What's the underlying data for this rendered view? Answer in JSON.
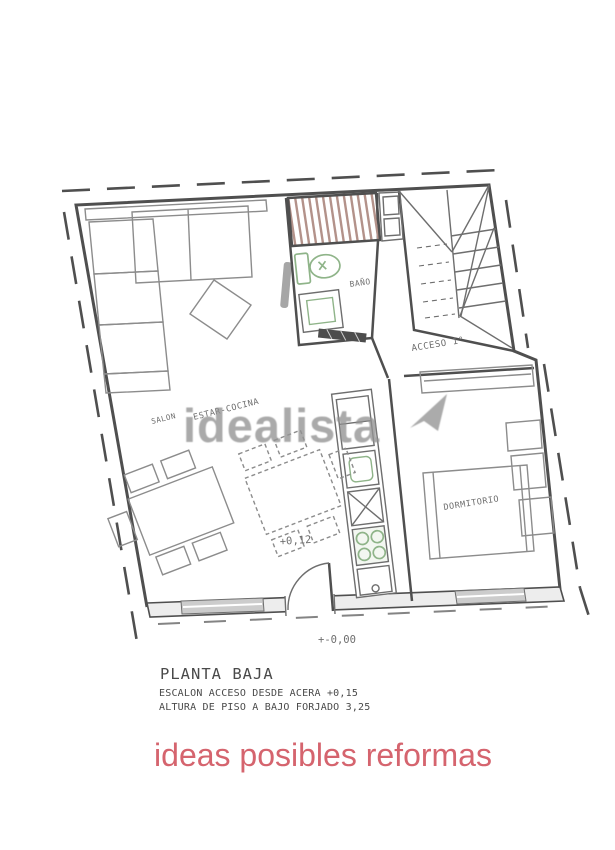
{
  "colors": {
    "line": "#4f4f4f",
    "line-mid": "#6e6e6e",
    "line-light": "#8c8c8c",
    "stripe": "#b3928a",
    "fixture": "#8fb489",
    "window-fill": "#cccccc",
    "wall-band": "#ededed",
    "watermark": "#939393",
    "caption": "#d5646e",
    "text": "#4a4a4a"
  },
  "plan": {
    "labels": {
      "bathroom": "BAÑO",
      "stairs": "ACCESO 1°",
      "bedroom": "DORMITORIO",
      "living_1": "SALON",
      "living_2": "ESTAR-COCINA",
      "level_interior": "+0,12",
      "level_entrance": "+-0,00"
    }
  },
  "title_block": {
    "title": "PLANTA BAJA",
    "note_1": "ESCALON ACCESO DESDE ACERA +0,15",
    "note_2": "ALTURA DE PISO A BAJO FORJADO 3,25"
  },
  "watermark": {
    "text": "idealista"
  },
  "caption": {
    "text": "ideas posibles reformas"
  }
}
